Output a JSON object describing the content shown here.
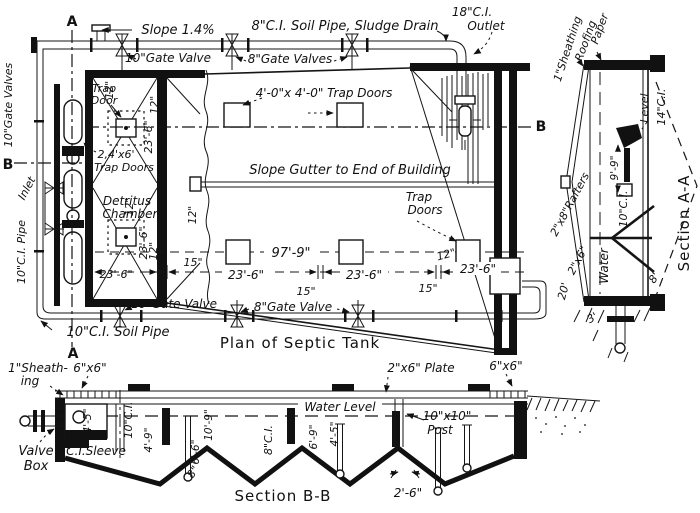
{
  "plan": {
    "title": "Plan of Septic Tank",
    "cut": {
      "a": "A",
      "b": "B"
    },
    "labels": {
      "slope": "Slope 1.4%",
      "soil_pipe_top": "8\"C.I. Soil Pipe, Sludge Drain",
      "outlet1": "18\"C.I.",
      "outlet2": "Outlet",
      "gv10_top": "10\"Gate Valve",
      "gv8_top": "8\"Gate Valves",
      "trap1": "Trap",
      "trap2": "Door",
      "trap4x4": "4'-0\"x 4'-0\" Trap Doors",
      "gutter": "Slope Gutter to End of Building",
      "td24_1": "2,4'x6'",
      "td24_2": "Trap Doors",
      "det1": "Detritus",
      "det2": "Chamber",
      "trapr1": "Trap",
      "trapr2": "Doors",
      "left_valves": "10\"Gate Valves",
      "inlet": "Inlet",
      "left_pipe": "10\"C.I. Pipe",
      "gv10_bot": "10\"Gate Valve",
      "gv8_bot": "8\"Gate Valve",
      "soil_pipe_bot": "10\"C.I. Soil Pipe"
    },
    "dims": {
      "d97": "97'-9\"",
      "d23": "23'-6\"",
      "d15": "15\"",
      "d12": "12\""
    }
  },
  "section_aa": {
    "title": "Section A-A",
    "labels": {
      "sheathing": "1\"Sheathing",
      "roofing": "Roofing",
      "paper": "Paper",
      "rafters": "2\"x8\"Rafters",
      "two_six": "2\"x6\"",
      "twenty": "20'",
      "level": "Level",
      "ci14": "14\"C.I.",
      "ci10": "10\"C.I.",
      "water": "Water"
    },
    "dims": {
      "d99": "9'-9\"",
      "d8": "8'",
      "d3": "3'"
    }
  },
  "section_bb": {
    "title": "Section B-B",
    "labels": {
      "sheath1": "1\"Sheath-",
      "sheath2": "ing",
      "six_six": "6\"x6\"",
      "valve1": "Valve",
      "valve2": "Box",
      "sleeve": "C.I.Sleeve",
      "ci10": "10\"C.I.",
      "ci8": "8\"C.I.",
      "water_level": "Water Level",
      "plate": "2\"x6\" Plate",
      "post1": "10\"x10\"",
      "post2": "Post"
    },
    "dims": {
      "d45": "4'-5\"",
      "d49": "4'-9\"",
      "d109": "10'-9\"",
      "d66": "6'-6\"",
      "d69": "6'-9\"",
      "d8": "8\"",
      "d26": "2'-6\""
    }
  }
}
